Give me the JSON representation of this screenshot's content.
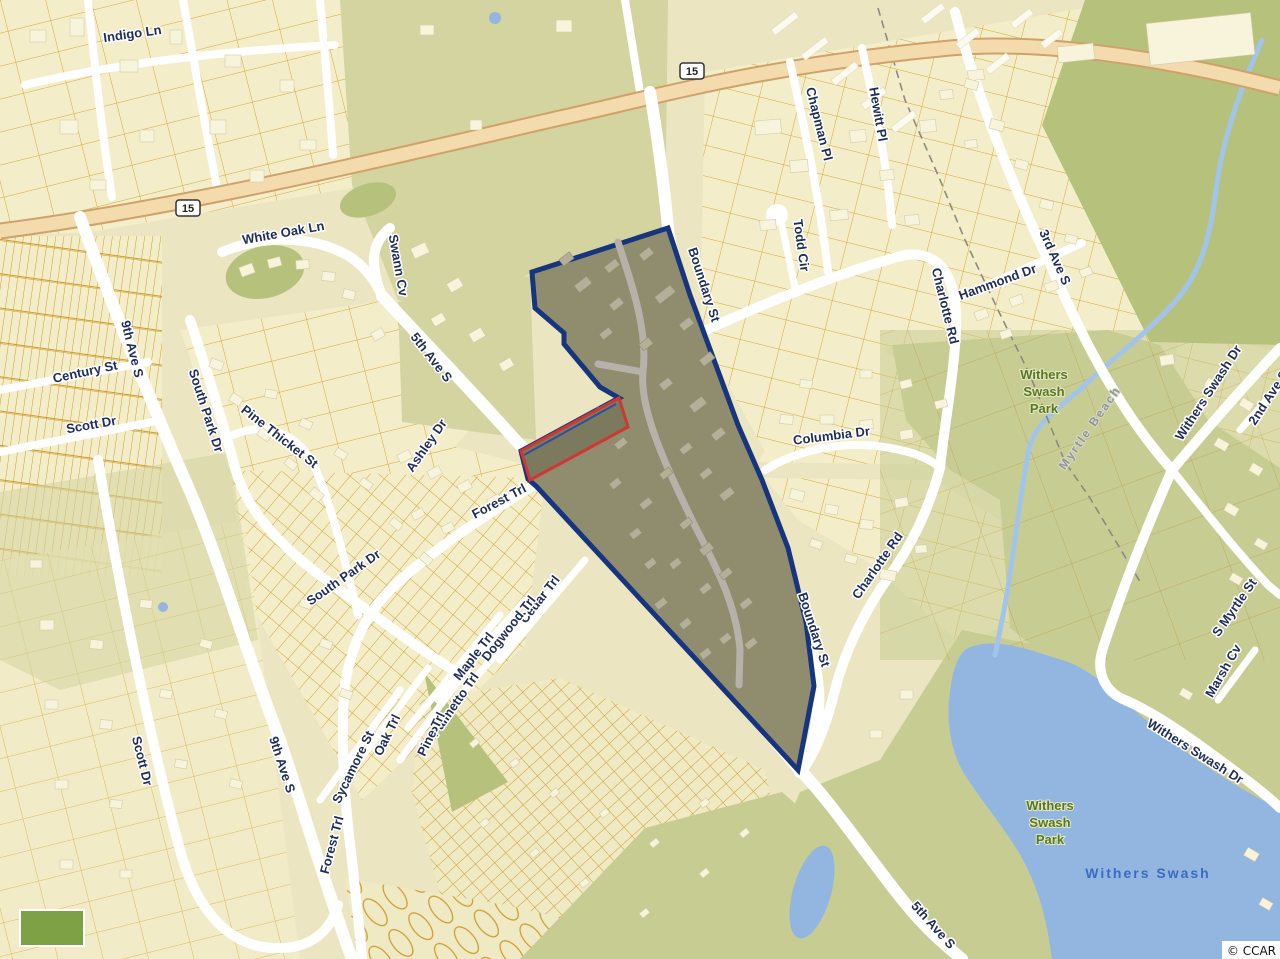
{
  "map": {
    "type": "parcel-map",
    "attribution": "© CCAR",
    "route_shield": "15",
    "city_boundary_label": "Myrtle Beach",
    "streets": {
      "indigo_ln": "Indigo Ln",
      "white_oak_ln": "White Oak Ln",
      "swann_cv": "Swann Cv",
      "fifth_ave_s": "5th Ave S",
      "ninth_ave_s": "9th Ave S",
      "century_st": "Century St",
      "scott_dr": "Scott Dr",
      "south_park_dr": "South Park Dr",
      "pine_thicket_st": "Pine Thicket St",
      "ashley_dr": "Ashley Dr",
      "forest_trl": "Forest Trl",
      "cedar_trl": "Cedar Trl",
      "dogwood_trl": "Dogwood Trl",
      "maple_trl": "Maple Trl",
      "palmetto_trl": "Palmetto Trl",
      "pine_trl": "Pine Trl",
      "oak_trl": "Oak Trl",
      "sycamore_st": "Sycamore St",
      "boundary_st": "Boundary St",
      "chapman_pl": "Chapman Pl",
      "hewitt_pl": "Hewitt Pl",
      "todd_cir": "Todd Cir",
      "charlotte_rd": "Charlotte Rd",
      "hammond_dr": "Hammond Dr",
      "third_ave_s": "3rd Ave S",
      "columbia_dr": "Columbia Dr",
      "withers_swash_dr": "Withers Swash Dr",
      "second_ave_s": "2nd Ave S",
      "s_myrtle_st": "S Myrtle St",
      "marsh_cv": "Marsh Cv"
    },
    "places": {
      "park_line1": "Withers",
      "park_line2": "Swash",
      "park_line3": "Park",
      "withers_swash": "Withers Swash"
    },
    "colors": {
      "navy": "#16357e",
      "red": "#cf3832",
      "water": "#93b6e0",
      "olive": "#d4d4a1",
      "park_green": "#b6c27c",
      "hwy_fill": "#f3dbae",
      "hwy_edge": "#d0a169",
      "label_navy": "#1e2d5a",
      "park_label": "#55791c",
      "water_label": "#3a6bc2",
      "city_label": "#90959c"
    }
  }
}
